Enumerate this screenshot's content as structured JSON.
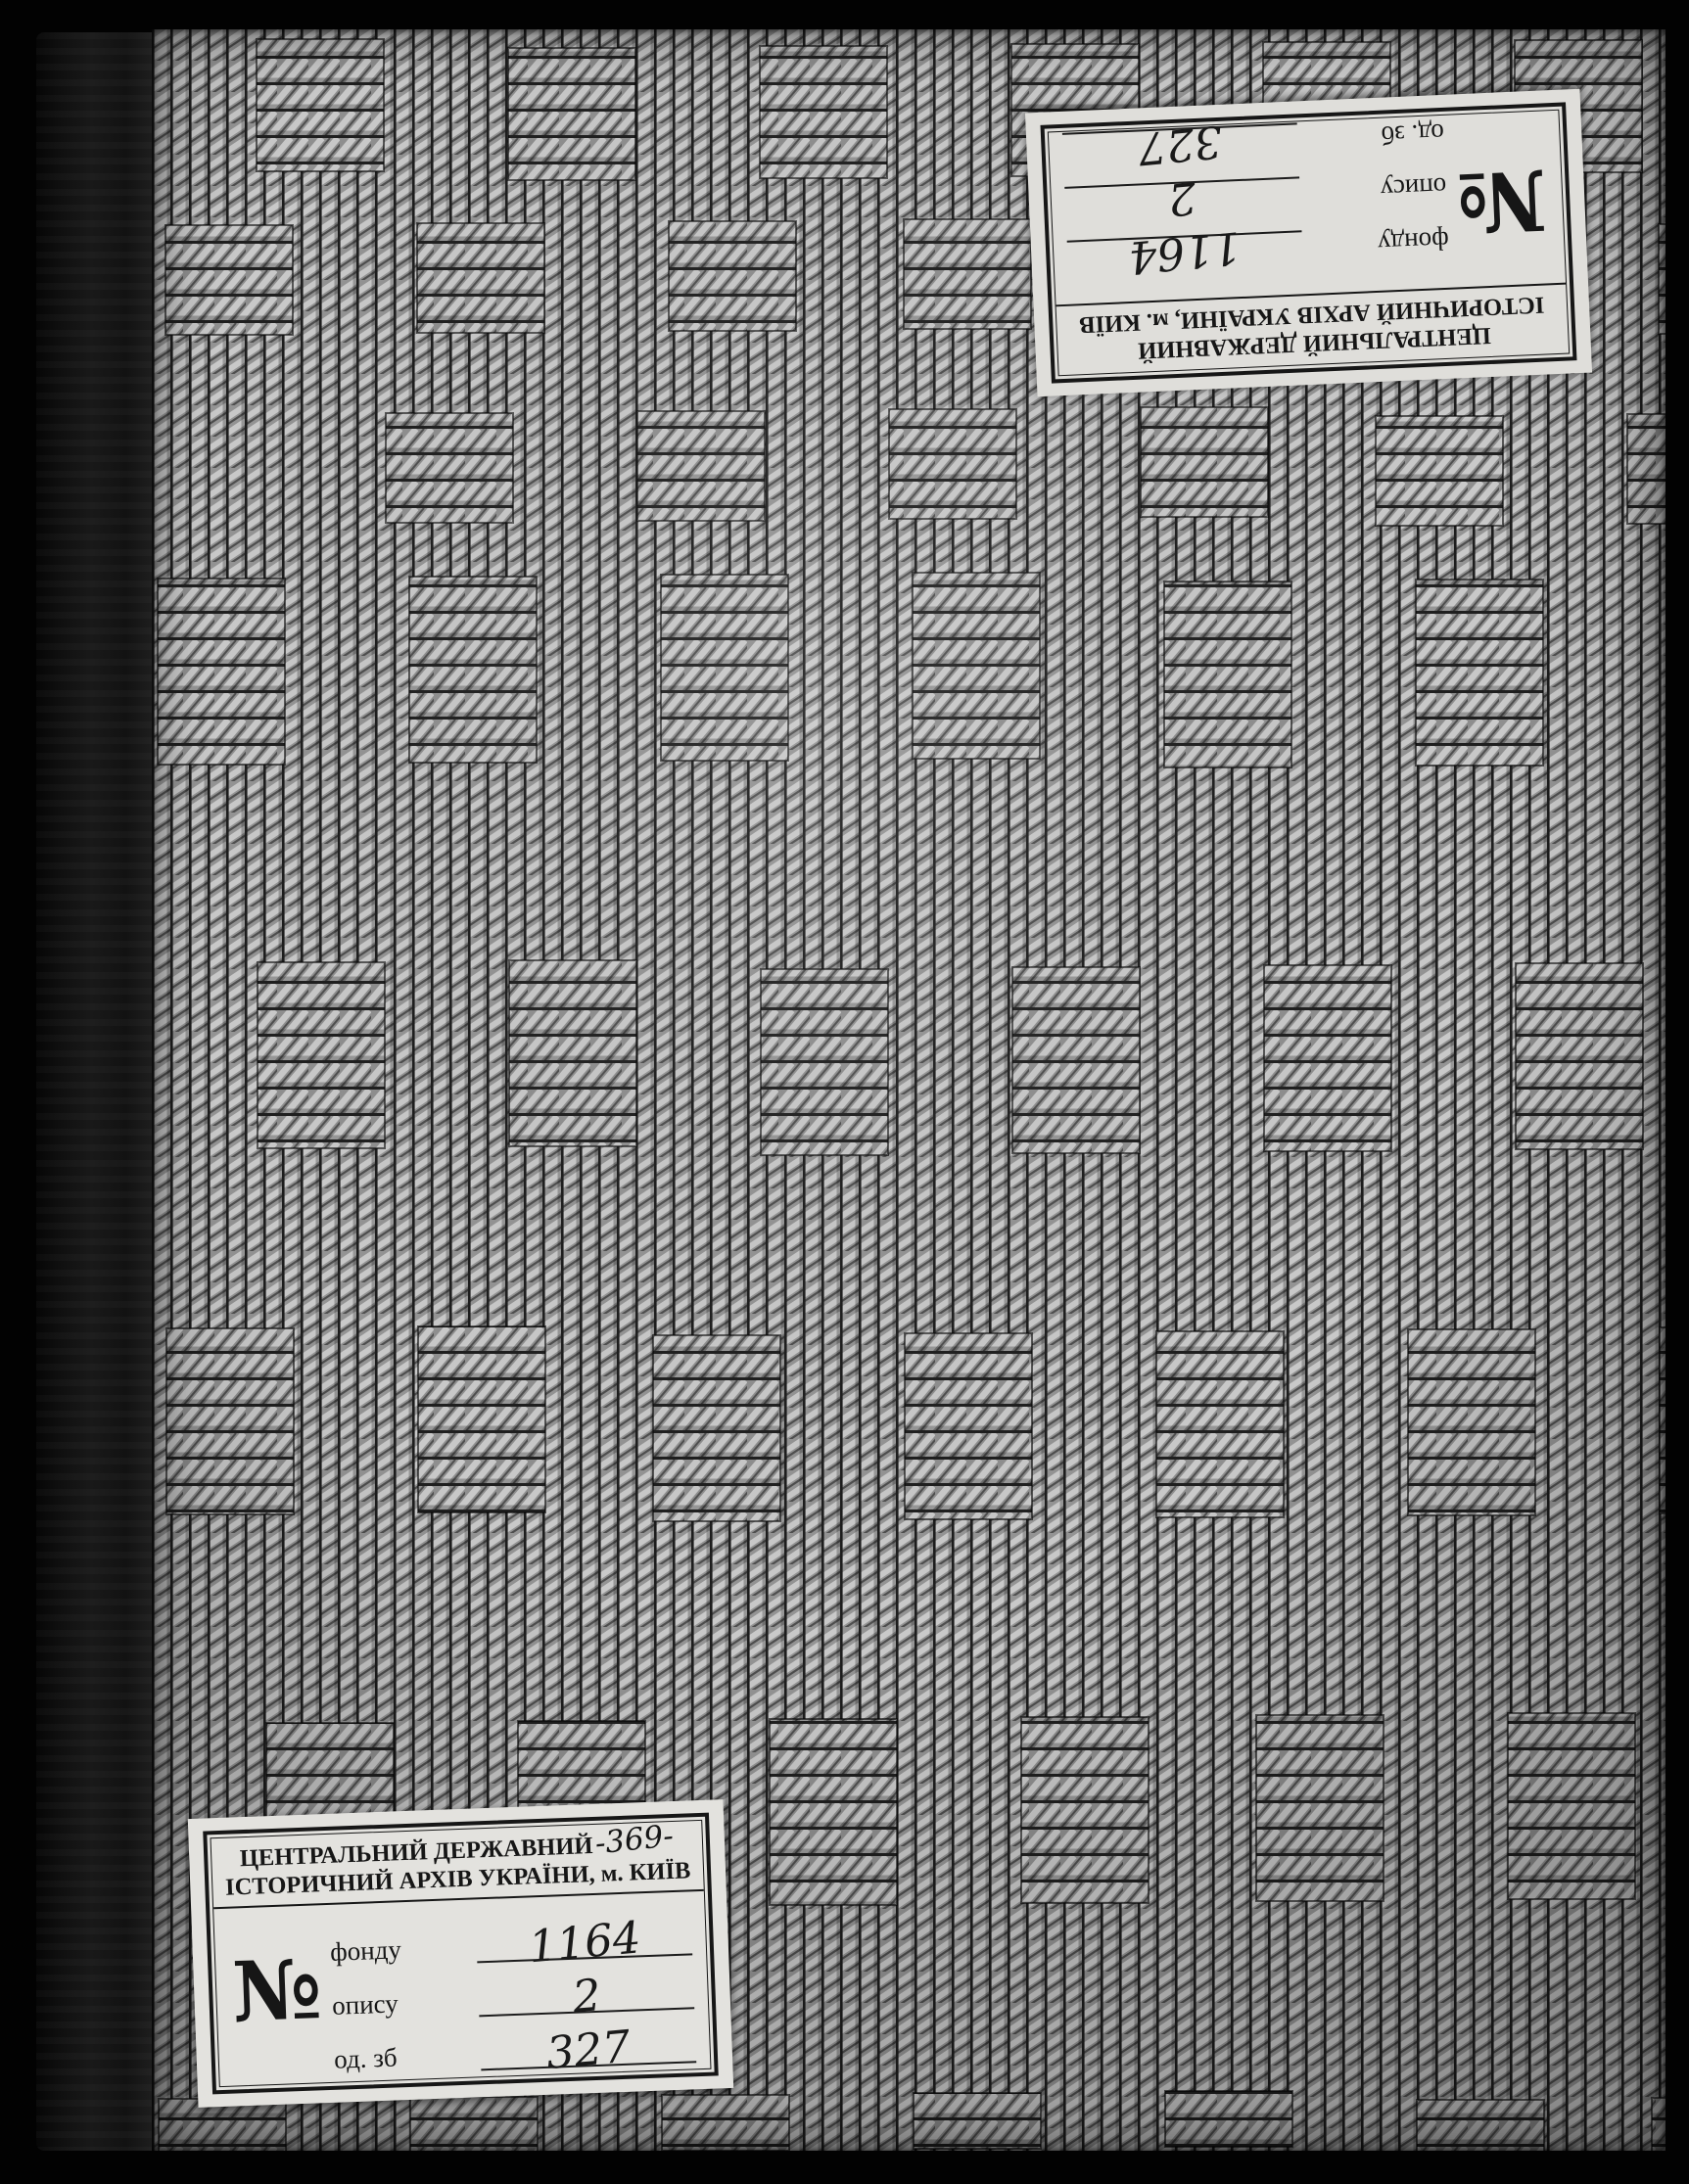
{
  "labels": {
    "top": {
      "org_line1": "ЦЕНТРАЛЬНИЙ ДЕРЖАВНИЙ",
      "org_line2": "ІСТОРИЧНИЙ АРХІВ УКРАЇНИ, м. КИЇВ",
      "number_sign": "№",
      "rows": [
        {
          "label": "фонду",
          "value": "1164"
        },
        {
          "label": "опису",
          "value": "2"
        },
        {
          "label": "од. зб",
          "value": "327"
        }
      ]
    },
    "bottom": {
      "org_line1": "ЦЕНТРАЛЬНИЙ ДЕРЖАВНИЙ",
      "annotation": "-369-",
      "org_line2": "ІСТОРИЧНИЙ АРХІВ УКРАЇНИ, м. КИЇВ",
      "number_sign": "№",
      "rows": [
        {
          "label": "фонду",
          "value": "1164"
        },
        {
          "label": "опису",
          "value": "2"
        },
        {
          "label": "од. зб",
          "value": "327"
        }
      ]
    }
  },
  "colors": {
    "background": "#020202",
    "spine": "#141414",
    "cord_light": "#cbcbcb",
    "cord_mid": "#949494",
    "cord_gap": "#1d1d1d",
    "label_paper": "#e3e2de",
    "label_ink": "#161616"
  }
}
